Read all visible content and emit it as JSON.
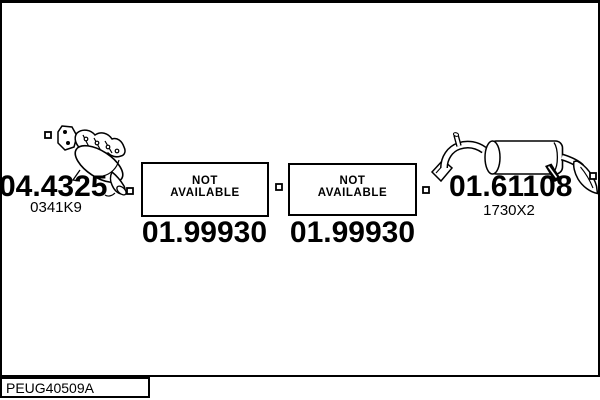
{
  "page": {
    "background": "#ffffff",
    "ink": "#000000",
    "footer_code": "PEUG40509A"
  },
  "parts": {
    "manifold": {
      "number": "04.4325",
      "ref_code": "0341K9"
    },
    "middle_left": {
      "status_line1": "NOT",
      "status_line2": "AVAILABLE",
      "number": "01.99930"
    },
    "middle_right": {
      "status_line1": "NOT",
      "status_line2": "AVAILABLE",
      "number": "01.99930"
    },
    "rear_silencer": {
      "number": "01.61108",
      "ref_code": "1730X2"
    }
  },
  "icons": {
    "connector_marker": "hollow-square",
    "manifold_art": "exhaust-manifold-with-catalyst",
    "silencer_art": "rear-silencer-with-tailpipe"
  }
}
